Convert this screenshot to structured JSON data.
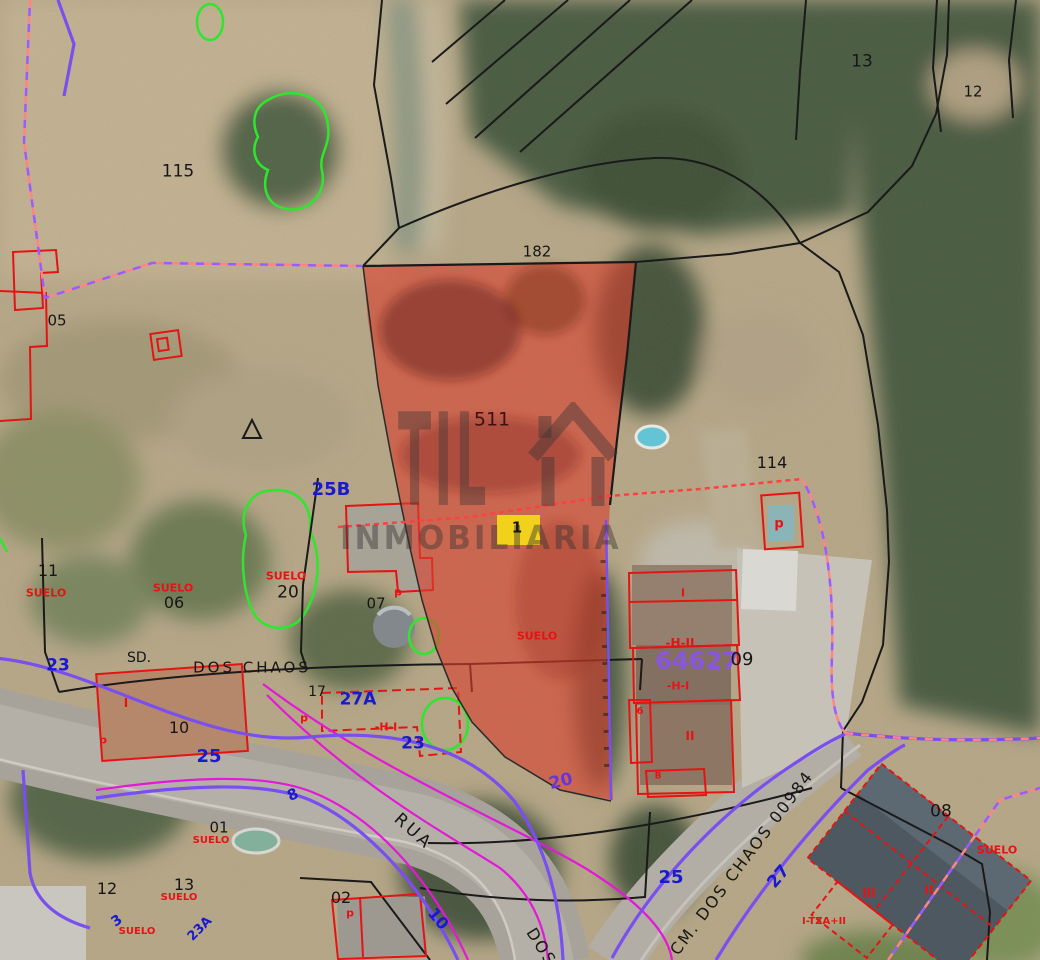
{
  "map": {
    "type": "cadastral-aerial-map",
    "watermark": {
      "logo_text": "TIL",
      "logo_icon": "house-icon",
      "subtext": "INMOBILIARIA"
    },
    "highlight_parcel": {
      "parcel_number": "511",
      "status_label": "SUELO",
      "marker_number": "1",
      "boundary_label": "182"
    },
    "colors": {
      "parcel_highlight": "#d8402e",
      "cadastral_line": "#1a1a1a",
      "building_outline": "#e51414",
      "vegetation_outline": "#2ee62e",
      "road_axis_purple": "#7a4ff0",
      "road_axis_magenta": "#e318d8",
      "boundary_dashed_pink": "#ff8585",
      "boundary_dashed_violet": "#9a5cff",
      "house_number_blue": "#1a1acd",
      "cadastral_code_purple": "#8a55e0",
      "marker_yellow": "#f2d11c",
      "suelo_red": "#e51414"
    },
    "labels": [
      {
        "text": "115",
        "name": "parcel-115-label",
        "x": 178,
        "y": 172,
        "color": "#161616",
        "size": 17
      },
      {
        "text": "13",
        "name": "parcel-13-label",
        "x": 862,
        "y": 62,
        "color": "#161616",
        "size": 17
      },
      {
        "text": "12",
        "name": "parcel-12-label",
        "x": 973,
        "y": 92,
        "color": "#161616",
        "size": 15
      },
      {
        "text": "182",
        "name": "boundary-length-label",
        "x": 537,
        "y": 252,
        "color": "#161616",
        "size": 15
      },
      {
        "text": "05",
        "name": "parcel-05-label",
        "x": 57,
        "y": 321,
        "color": "#161616",
        "size": 15
      },
      {
        "text": "511",
        "name": "highlight-parcel-number",
        "x": 492,
        "y": 420,
        "color": "#401010",
        "size": 19
      },
      {
        "text": "114",
        "name": "parcel-114-label",
        "x": 772,
        "y": 463,
        "color": "#161616",
        "size": 16
      },
      {
        "text": "25B",
        "name": "house-number-25b",
        "x": 331,
        "y": 490,
        "color": "#1a1acd",
        "size": 18,
        "bold": true
      },
      {
        "text": "11",
        "name": "parcel-11-label",
        "x": 48,
        "y": 571,
        "color": "#161616",
        "size": 16
      },
      {
        "text": "SUELO",
        "name": "suelo-label",
        "x": 46,
        "y": 593,
        "color": "#e51414",
        "size": 11,
        "bold": true
      },
      {
        "text": "SUELO",
        "name": "suelo-label",
        "x": 173,
        "y": 588,
        "color": "#e51414",
        "size": 11,
        "bold": true
      },
      {
        "text": "06",
        "name": "parcel-06-label",
        "x": 174,
        "y": 603,
        "color": "#161616",
        "size": 16
      },
      {
        "text": "SUELO",
        "name": "suelo-label",
        "x": 286,
        "y": 576,
        "color": "#e51414",
        "size": 11,
        "bold": true
      },
      {
        "text": "20",
        "name": "parcel-20-label",
        "x": 288,
        "y": 593,
        "color": "#161616",
        "size": 17
      },
      {
        "text": "07",
        "name": "parcel-07-label",
        "x": 376,
        "y": 604,
        "color": "#161616",
        "size": 15
      },
      {
        "text": "p",
        "name": "building-use-label",
        "x": 398,
        "y": 592,
        "color": "#e51414",
        "size": 11,
        "bold": true
      },
      {
        "text": "1",
        "name": "marker-1-label",
        "x": 517,
        "y": 528,
        "color": "#161616",
        "size": 15,
        "bold": true
      },
      {
        "text": "SUELO",
        "name": "highlight-parcel-suelo-label",
        "x": 537,
        "y": 636,
        "color": "#e51414",
        "size": 11,
        "bold": true
      },
      {
        "text": "I",
        "name": "building-height-label",
        "x": 683,
        "y": 593,
        "color": "#e51414",
        "size": 11,
        "bold": true
      },
      {
        "text": "-H-II",
        "name": "building-height-label",
        "x": 680,
        "y": 643,
        "color": "#e51414",
        "size": 12,
        "bold": true
      },
      {
        "text": "64627",
        "name": "cadastral-code-label",
        "x": 697,
        "y": 661,
        "color": "#8a55e0",
        "size": 24,
        "bold": true
      },
      {
        "text": "09",
        "name": "parcel-09-label",
        "x": 742,
        "y": 660,
        "color": "#161616",
        "size": 18
      },
      {
        "text": "-H-I",
        "name": "building-height-label",
        "x": 678,
        "y": 686,
        "color": "#e51414",
        "size": 11,
        "bold": true
      },
      {
        "text": "6",
        "name": "building-height-label",
        "x": 640,
        "y": 712,
        "color": "#e51414",
        "size": 10,
        "bold": true
      },
      {
        "text": "II",
        "name": "building-height-label",
        "x": 690,
        "y": 736,
        "color": "#e51414",
        "size": 12,
        "bold": true
      },
      {
        "text": "B",
        "name": "building-height-label",
        "x": 658,
        "y": 777,
        "color": "#e51414",
        "size": 9,
        "bold": true
      },
      {
        "text": "23",
        "name": "house-number-23",
        "x": 58,
        "y": 666,
        "color": "#1a1acd",
        "size": 17,
        "bold": true
      },
      {
        "text": "SD.",
        "name": "street-label-sd",
        "x": 139,
        "y": 658,
        "color": "#161616",
        "size": 14
      },
      {
        "text": "DOS CHAOS",
        "name": "street-label-dos-chaos",
        "x": 252,
        "y": 668,
        "color": "#161616",
        "size": 15,
        "ls": 3
      },
      {
        "text": "17",
        "name": "parcel-17-label",
        "x": 317,
        "y": 692,
        "color": "#161616",
        "size": 14
      },
      {
        "text": "27A",
        "name": "house-number-27a",
        "x": 358,
        "y": 700,
        "color": "#1a1acd",
        "size": 17,
        "bold": true
      },
      {
        "text": "I",
        "name": "building-height-label",
        "x": 126,
        "y": 703,
        "color": "#e51414",
        "size": 12,
        "bold": true
      },
      {
        "text": "10",
        "name": "parcel-10-label",
        "x": 179,
        "y": 728,
        "color": "#161616",
        "size": 16
      },
      {
        "text": "p",
        "name": "building-use-label",
        "x": 103,
        "y": 740,
        "color": "#e51414",
        "size": 11,
        "bold": true
      },
      {
        "text": "p",
        "name": "building-use-label",
        "x": 304,
        "y": 718,
        "color": "#e51414",
        "size": 11,
        "bold": true
      },
      {
        "text": "-H-I",
        "name": "building-height-label",
        "x": 386,
        "y": 727,
        "color": "#e51414",
        "size": 11,
        "bold": true
      },
      {
        "text": "25",
        "name": "house-number-25",
        "x": 209,
        "y": 757,
        "color": "#1a1acd",
        "size": 18,
        "bold": true
      },
      {
        "text": "23",
        "name": "house-number-23b",
        "x": 413,
        "y": 744,
        "color": "#1a1acd",
        "size": 17,
        "bold": true
      },
      {
        "text": "20",
        "name": "house-number-20",
        "x": 561,
        "y": 782,
        "color": "#6a35d8",
        "size": 17,
        "bold": true,
        "rot": -14
      },
      {
        "text": "8",
        "name": "house-number-8",
        "x": 293,
        "y": 795,
        "color": "#1a1acd",
        "size": 15,
        "bold": true,
        "rot": -25
      },
      {
        "text": "01",
        "name": "parcel-01-label",
        "x": 219,
        "y": 828,
        "color": "#161616",
        "size": 15
      },
      {
        "text": "SUELO",
        "name": "suelo-label",
        "x": 211,
        "y": 841,
        "color": "#e51414",
        "size": 10,
        "bold": true
      },
      {
        "text": "12",
        "name": "parcel-12b-label",
        "x": 107,
        "y": 889,
        "color": "#161616",
        "size": 16
      },
      {
        "text": "13",
        "name": "parcel-13b-label",
        "x": 184,
        "y": 885,
        "color": "#161616",
        "size": 16
      },
      {
        "text": "SUELO",
        "name": "suelo-label",
        "x": 179,
        "y": 898,
        "color": "#e51414",
        "size": 10,
        "bold": true
      },
      {
        "text": "3",
        "name": "house-number-3",
        "x": 117,
        "y": 921,
        "color": "#1a1acd",
        "size": 14,
        "bold": true,
        "rot": -35
      },
      {
        "text": "SUELO",
        "name": "suelo-label",
        "x": 137,
        "y": 932,
        "color": "#e51414",
        "size": 10,
        "bold": true
      },
      {
        "text": "23A",
        "name": "house-number-23a",
        "x": 200,
        "y": 929,
        "color": "#1a1acd",
        "size": 13,
        "bold": true,
        "rot": -45
      },
      {
        "text": "02",
        "name": "parcel-02-label",
        "x": 341,
        "y": 898,
        "color": "#161616",
        "size": 16
      },
      {
        "text": "p",
        "name": "building-use-label",
        "x": 350,
        "y": 913,
        "color": "#e51414",
        "size": 11,
        "bold": true
      },
      {
        "text": "RUA",
        "name": "street-label-rua",
        "x": 413,
        "y": 832,
        "color": "#161616",
        "size": 17,
        "rot": 42,
        "ls": 3
      },
      {
        "text": "10",
        "name": "house-number-10",
        "x": 438,
        "y": 919,
        "color": "#1a1acd",
        "size": 16,
        "bold": true,
        "rot": 50
      },
      {
        "text": "DOS",
        "name": "street-label-dos",
        "x": 541,
        "y": 947,
        "color": "#161616",
        "size": 16,
        "rot": 58,
        "ls": 2
      },
      {
        "text": "25",
        "name": "house-number-25b2",
        "x": 671,
        "y": 878,
        "color": "#1a1acd",
        "size": 18,
        "bold": true
      },
      {
        "text": "CM. DOS CHAOS 00984",
        "name": "street-label-cm-dos-chaos",
        "x": 742,
        "y": 863,
        "color": "#161616",
        "size": 16,
        "rot": -53,
        "ls": 2
      },
      {
        "text": "27",
        "name": "house-number-27",
        "x": 779,
        "y": 877,
        "color": "#1a1acd",
        "size": 17,
        "bold": true,
        "rot": -50
      },
      {
        "text": "08",
        "name": "parcel-08-label",
        "x": 941,
        "y": 812,
        "color": "#161616",
        "size": 17
      },
      {
        "text": "SUELO",
        "name": "suelo-label",
        "x": 997,
        "y": 850,
        "color": "#e51414",
        "size": 11,
        "bold": true
      },
      {
        "text": "III",
        "name": "building-height-label",
        "x": 869,
        "y": 893,
        "color": "#e51414",
        "size": 12,
        "bold": true
      },
      {
        "text": "II",
        "name": "building-height-label",
        "x": 929,
        "y": 890,
        "color": "#e51414",
        "size": 12,
        "bold": true
      },
      {
        "text": "I-TZA+II",
        "name": "building-height-label",
        "x": 824,
        "y": 922,
        "color": "#e51414",
        "size": 10,
        "bold": true
      },
      {
        "text": "p",
        "name": "building-use-label",
        "x": 779,
        "y": 524,
        "color": "#e51414",
        "size": 13,
        "bold": true
      }
    ]
  }
}
